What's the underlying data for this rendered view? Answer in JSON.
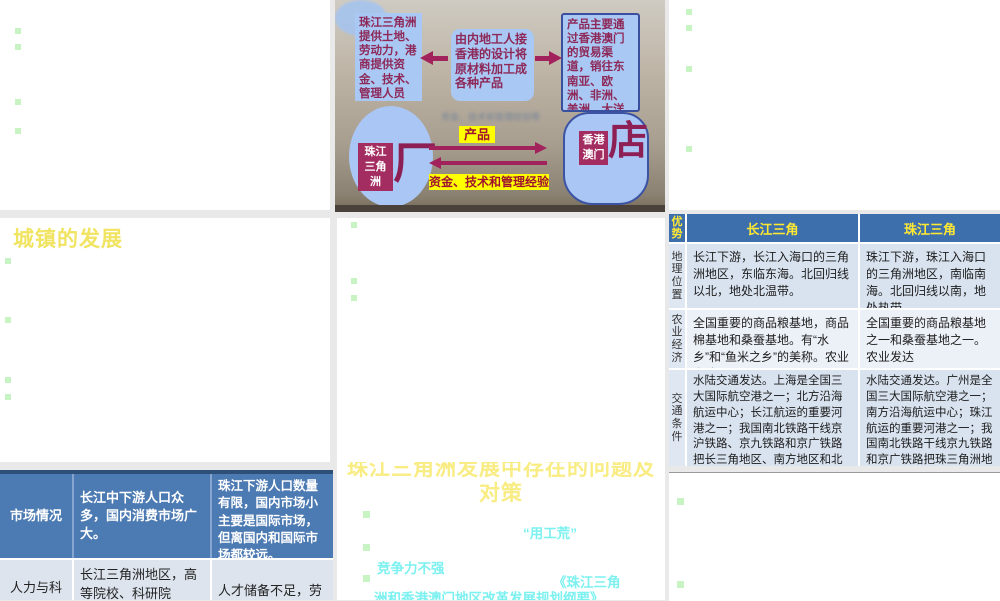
{
  "colors": {
    "table_header_blue": "#3e6fad",
    "market_row_blue": "#4c7ab2",
    "bullet_green": "#c8f3c3",
    "title_yellow": "#f0e462",
    "cyan_text": "#7df0f0",
    "diagram_maroon": "#a32d60",
    "diagram_box_blue": "#a9c8f3",
    "highlight_yellow": "#ffff00"
  },
  "diagram": {
    "box_left": "珠江三角洲提供土地、劳动力，港商提供资金、技术、管理人员",
    "box_middle": "由内地工人接香港的设计将原材料加工成各种产品",
    "box_right": "产品主要通过香港澳门的贸易渠道，销往东南亚、欧洲、非洲、美洲、大洋洲等地区",
    "ellipse_label": "珠江三角洲",
    "factory_char": "厂",
    "hk_label": "香港澳门",
    "shop_char": "店",
    "label_product": "产品",
    "label_capital": "资金、技术和管理经验",
    "faint_text_1": "资金、技术和管理经验等",
    "faint_text_2": "珠江三角"
  },
  "slide_towns": {
    "title": "城镇的发展"
  },
  "comparison_table": {
    "corner_label": "优势",
    "columns": [
      "长江三角",
      "珠江三角"
    ],
    "rows": [
      {
        "label": "地理位置",
        "changjiang": "长江下游，长江入海口的三角洲地区，东临东海。北回归线以北，地处北温带。",
        "zhujiang": "珠江下游，珠江入海口的三角洲地区，南临南海。北回归线以南，地处热带。"
      },
      {
        "label": "农业经济",
        "changjiang": "全国重要的商品粮基地，商品棉基地和桑蚕基地。有“水乡”和“鱼米之乡”的美称。农业发达。",
        "zhujiang": "全国重要的商品粮基地之一和桑蚕基地之一。农业发达"
      },
      {
        "label": "交通条件",
        "changjiang": "水陆交通发达。上海是全国三大国际航空港之一；北方沿海航运中心；长江航运的重要河港之一；我国南北铁路干线京沪铁路、京九铁路和京广铁路把长三角地区、南方地区和北方地区有机地连在了一起。",
        "zhujiang": "水陆交通发达。广州是全国三大国际航空港之一；南方沿海航运中心；珠江航运的重要河港之一；我国南北铁路干线京九铁路和京广铁路把珠三角洲地区、南方、北方地区有机地连在了一起。"
      }
    ]
  },
  "market_table": {
    "rows": [
      {
        "label": "市场情况",
        "changjiang": "长江中下游人口众多，国内消费市场广大。",
        "zhujiang": "珠江下游人口数量有限，国内市场小主要是国际市场，但离国内和国际市场都较远。"
      },
      {
        "label": "人力与科",
        "changjiang": "长江三角洲地区，高等院校、科研院",
        "zhujiang": "人才储备不足，劳"
      }
    ]
  },
  "slide_problems": {
    "title_line1": "珠江三角洲发展中存在的问题及",
    "title_line2": "对策",
    "item1": "“用工荒”",
    "item2": "竞争力不强",
    "item3_line1": "《珠江三角",
    "item3_line2": "洲和香港澳门地区改革发展规划纲要》"
  }
}
